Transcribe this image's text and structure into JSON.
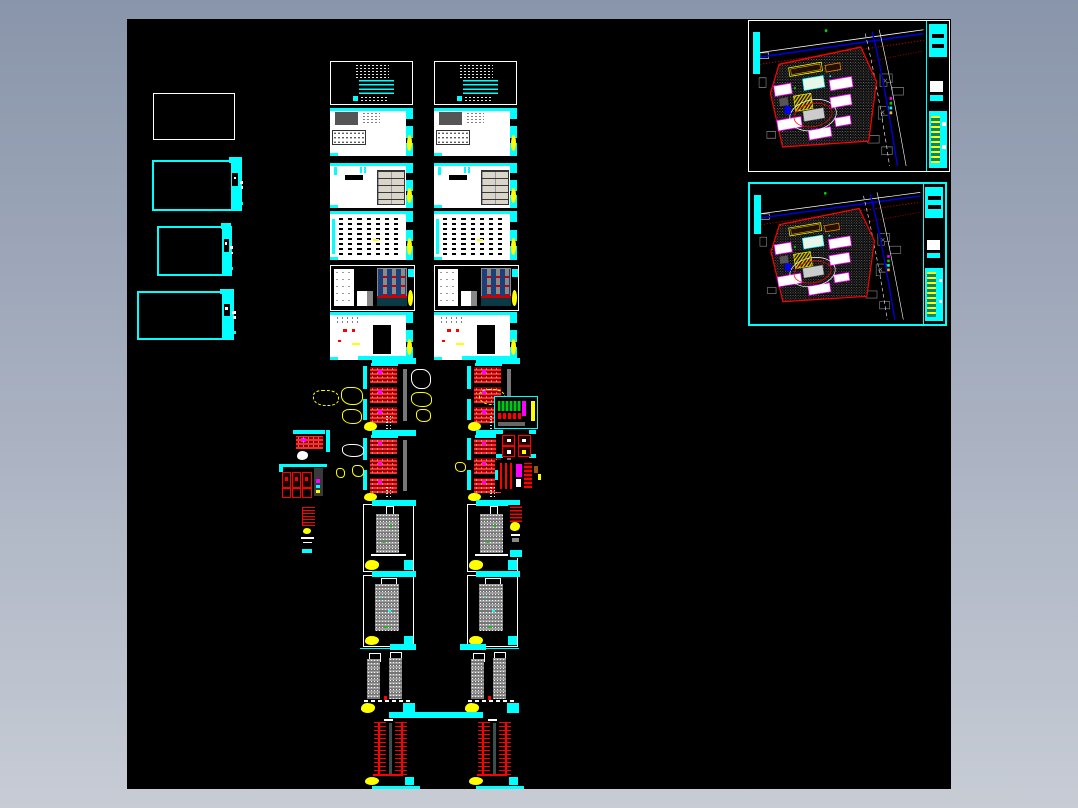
{
  "palette": {
    "page_bg_top": "#8995aa",
    "page_bg_bottom": "#c7ccd5",
    "canvas_bg": "#000000",
    "accent_cyan": "#00ffff",
    "accent_yellow": "#ffff00",
    "accent_red": "#ff0000",
    "accent_magenta": "#ff00ff",
    "accent_blue": "#0000dd",
    "accent_green": "#00cc00",
    "accent_orange": "#ff8800",
    "paper_white": "#ffffff",
    "table_tan": "#d9d5c8",
    "gray_building": "#8a8a8a",
    "gray_dark": "#555555"
  },
  "canvas": {
    "x": 127,
    "y": 19,
    "width": 824,
    "height": 770
  },
  "left_sheets": [
    {
      "id": "blank-sheet-1",
      "style": "white",
      "x": 26,
      "y": 74,
      "w": 80,
      "h": 45
    },
    {
      "id": "cyan-sheet-1",
      "style": "cyan",
      "x": 25,
      "y": 141,
      "w": 86,
      "h": 47
    },
    {
      "id": "cyan-sheet-2",
      "style": "cyan",
      "x": 30,
      "y": 207,
      "w": 71,
      "h": 46
    },
    {
      "id": "cyan-sheet-3",
      "style": "cyan",
      "x": 10,
      "y": 272,
      "w": 93,
      "h": 45
    }
  ],
  "sheet_columns": {
    "columns": [
      {
        "id": "col-a",
        "x": 203
      },
      {
        "id": "col-b",
        "x": 307
      }
    ],
    "rows": [
      {
        "type": "cover",
        "y": 42,
        "h": 42,
        "dx": 0,
        "w": 81
      },
      {
        "type": "sheet-gray",
        "y": 89,
        "h": 48,
        "dx": 0,
        "w": 83
      },
      {
        "type": "sheet-tan",
        "y": 144,
        "h": 45,
        "dx": 0,
        "w": 83
      },
      {
        "type": "sheet-schedule",
        "y": 192,
        "h": 49,
        "dx": 0,
        "w": 83
      },
      {
        "type": "facade",
        "y": 246,
        "h": 44,
        "dx": 0,
        "w": 83
      },
      {
        "type": "sheet-detail",
        "y": 293,
        "h": 48,
        "dx": 0,
        "w": 83
      },
      {
        "type": "plan-red",
        "y": 344,
        "h": 69,
        "dx": 33,
        "w": 47
      },
      {
        "type": "plan-red",
        "y": 416,
        "h": 67,
        "dx": 33,
        "w": 47
      },
      {
        "type": "elev-white",
        "y": 485,
        "h": 66,
        "dx": 33,
        "w": 49
      },
      {
        "type": "elev-tall",
        "y": 556,
        "h": 70,
        "dx": 33,
        "w": 49
      },
      {
        "type": "elev-twin",
        "y": 629,
        "h": 64,
        "dx": 30,
        "w": 55
      },
      {
        "type": "section-red",
        "y": 699,
        "h": 68,
        "dx": 34,
        "w": 50
      }
    ]
  },
  "site_plans": [
    {
      "id": "site-plan-1",
      "x": 621,
      "y": 1,
      "w": 200,
      "h": 150,
      "frame": "white"
    },
    {
      "id": "site-plan-2",
      "x": 621,
      "y": 163,
      "w": 195,
      "h": 140,
      "frame": "cyan"
    }
  ],
  "mini_tiles": [
    {
      "type": "mini-plan-a",
      "x": 166,
      "y": 411,
      "w": 37,
      "h": 31
    },
    {
      "type": "mini-plan-b",
      "x": 152,
      "y": 445,
      "w": 51,
      "h": 36
    },
    {
      "type": "strip-left",
      "x": 172,
      "y": 487,
      "w": 19,
      "h": 48
    },
    {
      "type": "mini-color",
      "x": 367,
      "y": 377,
      "w": 42,
      "h": 31
    },
    {
      "type": "mini-red-boxes",
      "x": 369,
      "y": 411,
      "w": 40,
      "h": 28
    },
    {
      "type": "mini-dense",
      "x": 368,
      "y": 441,
      "w": 46,
      "h": 32
    },
    {
      "type": "strip-right",
      "x": 381,
      "y": 486,
      "w": 17,
      "h": 53
    }
  ],
  "glyphs": [
    {
      "style": "dashed-yellow",
      "x": 186,
      "y": 371,
      "w": 24,
      "h": 14
    },
    {
      "style": "yellow",
      "x": 214,
      "y": 368,
      "w": 20,
      "h": 16
    },
    {
      "style": "yellow",
      "x": 215,
      "y": 390,
      "w": 18,
      "h": 13
    },
    {
      "style": "white",
      "x": 284,
      "y": 350,
      "w": 18,
      "h": 18
    },
    {
      "style": "yellow",
      "x": 284,
      "y": 373,
      "w": 19,
      "h": 13
    },
    {
      "style": "yellow",
      "x": 289,
      "y": 390,
      "w": 13,
      "h": 11
    },
    {
      "style": "dashed-yellow",
      "x": 352,
      "y": 370,
      "w": 24,
      "h": 14
    },
    {
      "style": "white",
      "x": 215,
      "y": 425,
      "w": 20,
      "h": 11
    },
    {
      "style": "yellow",
      "x": 209,
      "y": 449,
      "w": 7,
      "h": 8
    },
    {
      "style": "yellow",
      "x": 225,
      "y": 446,
      "w": 10,
      "h": 10
    },
    {
      "style": "yellow",
      "x": 328,
      "y": 443,
      "w": 9,
      "h": 8
    }
  ],
  "connectors": [
    {
      "x": 245,
      "y": 339,
      "w": 44,
      "h": 6
    },
    {
      "x": 349,
      "y": 339,
      "w": 44,
      "h": 6
    },
    {
      "x": 245,
      "y": 411,
      "w": 44,
      "h": 6
    },
    {
      "x": 349,
      "y": 411,
      "w": 44,
      "h": 6
    },
    {
      "x": 245,
      "y": 481,
      "w": 44,
      "h": 6
    },
    {
      "x": 349,
      "y": 481,
      "w": 44,
      "h": 6
    },
    {
      "x": 245,
      "y": 552,
      "w": 44,
      "h": 6
    },
    {
      "x": 349,
      "y": 552,
      "w": 44,
      "h": 6
    },
    {
      "x": 263,
      "y": 625,
      "w": 26,
      "h": 6
    },
    {
      "x": 333,
      "y": 625,
      "w": 26,
      "h": 6
    },
    {
      "x": 262,
      "y": 693,
      "w": 94,
      "h": 6
    },
    {
      "x": 245,
      "y": 767,
      "w": 48,
      "h": 6
    },
    {
      "x": 349,
      "y": 767,
      "w": 48,
      "h": 6
    }
  ]
}
